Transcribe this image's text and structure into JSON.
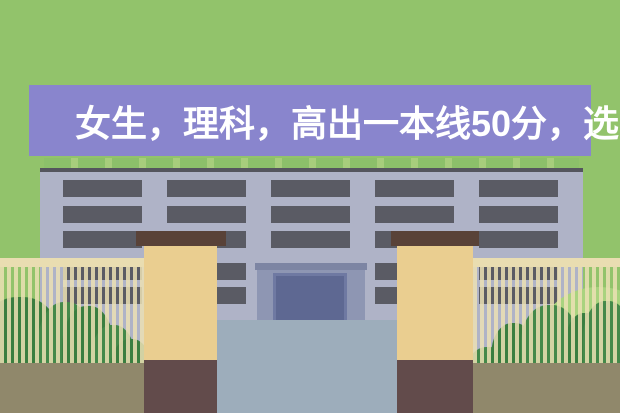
{
  "banner": {
    "text": "女生，理科，高出一本线50分，选"
  },
  "colors": {
    "bg": "#92C36B",
    "banner": "#8985CD",
    "banner_text": "#FFFFFF",
    "parapet_light": "#A7CD7C",
    "parapet_tab": "#8CC06A",
    "roofline": "#54555D",
    "facade": "#AFB3C7",
    "win_frame": "#5A5B64",
    "win_pane": "#C7D9E6",
    "porch_frame": "#8E96B3",
    "porch_top": "#7D85A3",
    "door_edge": "#6F79A2",
    "door_fill": "#5E6892",
    "plaza": "#9DADBB",
    "pillar": "#EACE90",
    "pillar_cap": "#594238",
    "pillar_base": "#624B4B",
    "fence": "#E9DDB1",
    "bush_dark": "#3A7E40",
    "bush_mid": "#44894A",
    "bush_light": "#A9D37F",
    "ground": "#90886B"
  }
}
